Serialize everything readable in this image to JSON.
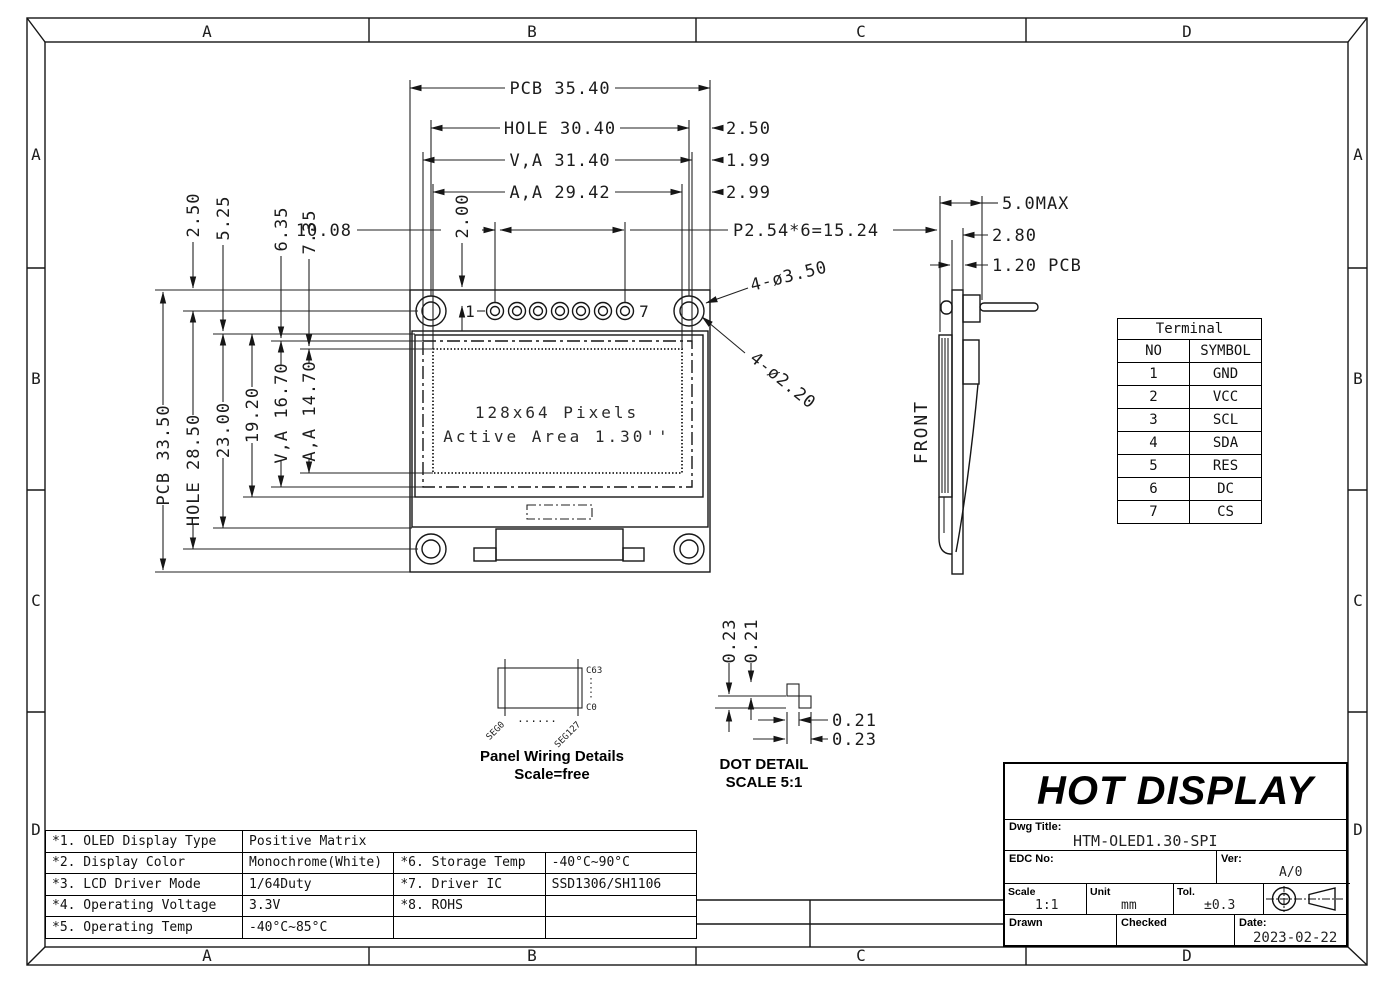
{
  "sheet": {
    "zones": [
      "A",
      "B",
      "C",
      "D"
    ]
  },
  "front_view": {
    "dim_pcb_width": "PCB 35.40",
    "dim_hole_width": "HOLE 30.40",
    "dim_va_width": "V,A 31.40",
    "dim_aa_width": "A,A 29.42",
    "dim_edge_to_hole": "2.50",
    "dim_edge_to_va": "1.99",
    "dim_edge_to_aa": "2.99",
    "dim_pin_offset": "10.08",
    "dim_pin_row": "2.00",
    "dim_pin_pitch": "P2.54*6=15.24",
    "pin_first": "1",
    "pin_last": "7",
    "dim_top_to_hole": "2.50",
    "dim_top_to_glass": "5.25",
    "dim_top_to_va": "6.35",
    "dim_top_to_aa": "7.35",
    "dim_pcb_height": "PCB 33.50",
    "dim_hole_height": "HOLE 28.50",
    "dim_glass_to_bottom": "23.00",
    "dim_glass_height": "19.20",
    "dim_va_height": "V,A 16.70",
    "dim_aa_height": "A,A 14.70",
    "callout_hole_outer": "4-ø3.50",
    "callout_hole_inner": "4-ø2.20",
    "display_line1": "128x64 Pixels",
    "display_line2": "Active Area 1.30''"
  },
  "side_view": {
    "label": "FRONT",
    "dim_total": "5.0MAX",
    "dim_header": "2.80",
    "dim_pcb": "1.20 PCB"
  },
  "panel_wiring": {
    "col_top": "C63",
    "col_bottom": "C0",
    "seg_first": "SEG0",
    "seg_gap": "......",
    "seg_last": "SEG127",
    "title": "Panel Wiring Details",
    "subtitle": "Scale=free"
  },
  "dot_detail": {
    "dim_v_outer": "0.23",
    "dim_v_inner": "0.21",
    "dim_h_inner": "0.21",
    "dim_h_outer": "0.23",
    "title": "DOT DETAIL",
    "subtitle": "SCALE 5:1"
  },
  "terminal_table": {
    "title": "Terminal",
    "col_no": "NO",
    "col_symbol": "SYMBOL",
    "rows": [
      [
        "1",
        "GND"
      ],
      [
        "2",
        "VCC"
      ],
      [
        "3",
        "SCL"
      ],
      [
        "4",
        "SDA"
      ],
      [
        "5",
        "RES"
      ],
      [
        "6",
        "DC"
      ],
      [
        "7",
        "CS"
      ]
    ]
  },
  "spec_table": {
    "rows": [
      [
        "*1. OLED Display Type",
        "Positive Matrix",
        "",
        ""
      ],
      [
        "*2. Display Color",
        "Monochrome(White)",
        "*6. Storage Temp",
        "-40°C~90°C"
      ],
      [
        "*3. LCD Driver Mode",
        "1/64Duty",
        "*7. Driver IC",
        "SSD1306/SH1106"
      ],
      [
        "*4. Operating Voltage",
        "3.3V",
        "*8. ROHS",
        ""
      ],
      [
        "*5. Operating Temp",
        "-40°C~85°C",
        "",
        ""
      ]
    ]
  },
  "title_block": {
    "company": "HOT DISPLAY",
    "dwg_title_label": "Dwg Title:",
    "dwg_title": "HTM-OLED1.30-SPI",
    "edc_no_label": "EDC No:",
    "edc_no": "",
    "ver_label": "Ver:",
    "ver": "A/0",
    "scale_label": "Scale",
    "scale": "1:1",
    "unit_label": "Unit",
    "unit": "mm",
    "tol_label": "Tol.",
    "tol": "±0.3",
    "drawn_label": "Drawn",
    "checked_label": "Checked",
    "date_label": "Date:",
    "date": "2023-02-22"
  }
}
